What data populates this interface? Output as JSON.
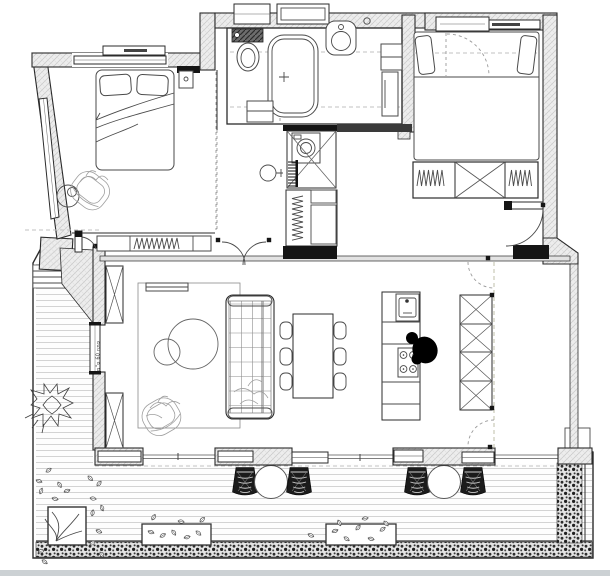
{
  "document": {
    "type": "architectural-floor-plan",
    "view": "top-down apartment plan with terrace"
  },
  "annotations": {
    "window_note": "פתח 60 ס\"מ"
  },
  "palette": {
    "bg": "#ffffff",
    "wallfill": "#ededed",
    "hatchline": "#c7c7c7",
    "outline": "#2b2b2b",
    "furn": "#4a4a4a",
    "sketch": "#9f9f9f",
    "dark": "#151515",
    "deck": "#c9c9c9",
    "hedge": "#2e2e2e",
    "shadow": "#ccd1d4",
    "dash": "#c2c2c2"
  },
  "rooms": [
    {
      "id": "bedroom-1",
      "items": [
        "double-bed",
        "pillows",
        "blanket",
        "nightstand",
        "armchair-sketch",
        "round-side-table",
        "built-in-wardrobe",
        "slanted-window",
        "top-window",
        "shutter-box"
      ]
    },
    {
      "id": "bathroom",
      "items": [
        "wall-hung-toilet",
        "cistern",
        "bathtub",
        "washbasin",
        "vanity-cabinet",
        "tall-cabinet",
        "low-cabinet",
        "pocket-door",
        "ceiling-light"
      ]
    },
    {
      "id": "utility-room",
      "items": [
        "shower-area-x",
        "washing-machine",
        "towel-radiator",
        "hand-basin",
        "linen-closet",
        "hanging-rod"
      ]
    },
    {
      "id": "bedroom-2",
      "items": [
        "double-bed",
        "pillows",
        "wardrobe-three-sections",
        "hanging-rods",
        "swing-door",
        "shutter-boxes"
      ]
    },
    {
      "id": "living-dining-kitchen",
      "items": [
        "rug",
        "tv-console",
        "tufted-sofa",
        "coffee-table-large",
        "coffee-table-small",
        "armchair-sketch",
        "dining-table",
        "dining-chairs-x6",
        "kitchen-island",
        "island-sink",
        "cooktop-4-burners",
        "person-silhouette",
        "tall-x-cabinet",
        "partition-track",
        "x-columns",
        "double-swing-doors"
      ]
    },
    {
      "id": "terrace",
      "items": [
        "wood-deck",
        "entry-door",
        "entry-steps",
        "ornamental-plant",
        "corner-planter-with-tree",
        "shrub-cluster",
        "planter-box-left",
        "planter-box-right",
        "bottom-hedge",
        "right-hedge",
        "woven-stools-x4",
        "round-tables-x2",
        "sliding-glass-wall"
      ]
    }
  ]
}
